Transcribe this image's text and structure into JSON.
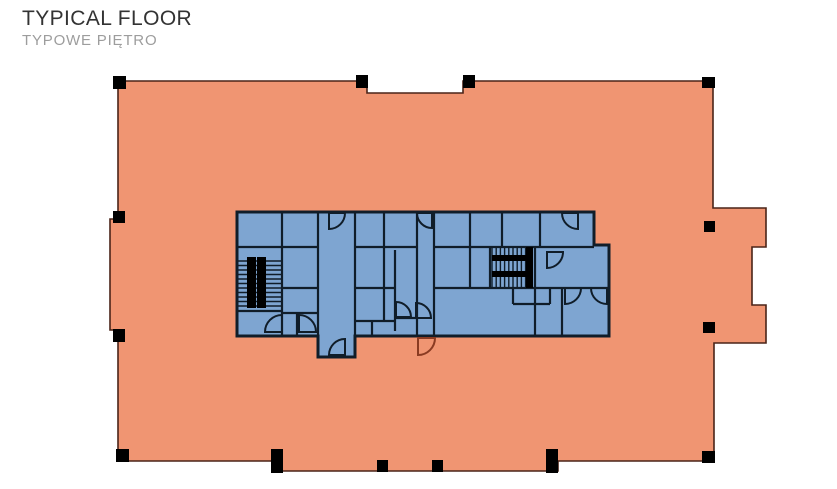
{
  "header": {
    "title": "TYPICAL FLOOR",
    "subtitle": "TYPOWE PIĘTRO"
  },
  "colors": {
    "background": "#ffffff",
    "floor": "#F09572",
    "floor_outline": "#4A2418",
    "core": "#7EA5D1",
    "core_walls": "#101D29",
    "columns": "#000000",
    "exterior_door": "#8A3B22",
    "title_text": "#333333",
    "subtitle_text": "#9D9D9D"
  },
  "floorplan": {
    "canvas": {
      "w": 837,
      "h": 489
    },
    "plate": {
      "outline": [
        [
          118,
          81
        ],
        [
          367,
          81
        ],
        [
          367,
          93
        ],
        [
          463,
          93
        ],
        [
          463,
          81
        ],
        [
          713,
          81
        ],
        [
          713,
          208
        ],
        [
          766,
          208
        ],
        [
          766,
          247
        ],
        [
          752,
          247
        ],
        [
          752,
          305
        ],
        [
          766,
          305
        ],
        [
          766,
          343
        ],
        [
          714,
          343
        ],
        [
          714,
          461
        ],
        [
          558,
          461
        ],
        [
          558,
          471
        ],
        [
          282,
          471
        ],
        [
          282,
          461
        ],
        [
          118,
          461
        ],
        [
          118,
          330
        ],
        [
          110,
          330
        ],
        [
          110,
          219
        ],
        [
          118,
          219
        ]
      ]
    },
    "column_marks": [
      [
        113,
        76,
        13,
        13
      ],
      [
        356,
        75,
        12,
        13
      ],
      [
        463,
        75,
        12,
        13
      ],
      [
        702,
        77,
        13,
        11
      ],
      [
        704,
        221,
        11,
        11
      ],
      [
        703,
        322,
        12,
        11
      ],
      [
        113,
        211,
        12,
        12
      ],
      [
        113,
        329,
        12,
        13
      ],
      [
        116,
        449,
        13,
        13
      ],
      [
        271,
        449,
        12,
        24
      ],
      [
        377,
        460,
        11,
        12
      ],
      [
        432,
        460,
        11,
        12
      ],
      [
        546,
        449,
        12,
        24
      ],
      [
        702,
        451,
        13,
        12
      ]
    ],
    "core": {
      "outline": [
        [
          237,
          212
        ],
        [
          594,
          212
        ],
        [
          594,
          245
        ],
        [
          609,
          245
        ],
        [
          609,
          336
        ],
        [
          355,
          336
        ],
        [
          355,
          357
        ],
        [
          318,
          357
        ],
        [
          318,
          336
        ],
        [
          237,
          336
        ]
      ],
      "walls": [
        [
          282,
          212,
          282,
          336
        ],
        [
          318,
          212,
          318,
          336
        ],
        [
          355,
          212,
          355,
          336
        ],
        [
          384,
          212,
          384,
          321
        ],
        [
          395,
          250,
          395,
          331
        ],
        [
          417,
          212,
          417,
          336
        ],
        [
          434,
          212,
          434,
          336
        ],
        [
          470,
          212,
          470,
          288
        ],
        [
          502,
          212,
          502,
          247
        ],
        [
          540,
          212,
          540,
          247
        ],
        [
          490,
          247,
          490,
          288
        ],
        [
          535,
          247,
          535,
          336
        ],
        [
          562,
          288,
          562,
          336
        ],
        [
          513,
          288,
          513,
          304
        ],
        [
          550,
          288,
          550,
          304
        ],
        [
          297,
          313,
          297,
          336
        ],
        [
          372,
          321,
          372,
          336
        ],
        [
          237,
          247,
          318,
          247
        ],
        [
          355,
          247,
          417,
          247
        ],
        [
          434,
          247,
          594,
          247
        ],
        [
          237,
          311,
          282,
          311
        ],
        [
          282,
          288,
          318,
          288
        ],
        [
          282,
          313,
          318,
          313
        ],
        [
          355,
          288,
          395,
          288
        ],
        [
          355,
          321,
          395,
          321
        ],
        [
          395,
          318,
          417,
          318
        ],
        [
          434,
          288,
          609,
          288
        ],
        [
          513,
          304,
          550,
          304
        ]
      ]
    },
    "stairs": [
      {
        "name": "stairs-west",
        "dir": "h",
        "x": 238,
        "y": 261,
        "w": 44,
        "h": 45,
        "gap": 4.5,
        "bars": [
          [
            247,
            257,
            9,
            51
          ],
          [
            257,
            257,
            9,
            51
          ]
        ]
      },
      {
        "name": "stairs-east",
        "dir": "v",
        "x": 492,
        "y": 247,
        "w": 41,
        "h": 41,
        "gap": 4.2,
        "bars": [
          [
            492,
            255,
            41,
            6
          ],
          [
            492,
            271,
            41,
            6
          ],
          [
            526,
            247,
            7,
            41
          ]
        ]
      }
    ],
    "doors": [
      {
        "geo": [
          329,
          213,
          16,
          "se"
        ]
      },
      {
        "geo": [
          345,
          355,
          16,
          "nw"
        ]
      },
      {
        "geo": [
          432,
          213,
          15,
          "sw"
        ]
      },
      {
        "geo": [
          418,
          338,
          17,
          "se"
        ],
        "exterior": true
      },
      {
        "geo": [
          282,
          332,
          17,
          "nw"
        ]
      },
      {
        "geo": [
          299,
          332,
          17,
          "ne"
        ]
      },
      {
        "geo": [
          396,
          317,
          15,
          "ne"
        ]
      },
      {
        "geo": [
          416,
          318,
          15,
          "ne"
        ]
      },
      {
        "geo": [
          547,
          252,
          16,
          "se"
        ]
      },
      {
        "geo": [
          565,
          288,
          16,
          "se"
        ]
      },
      {
        "geo": [
          607,
          288,
          16,
          "sw"
        ]
      },
      {
        "geo": [
          578,
          213,
          16,
          "sw"
        ]
      }
    ]
  }
}
